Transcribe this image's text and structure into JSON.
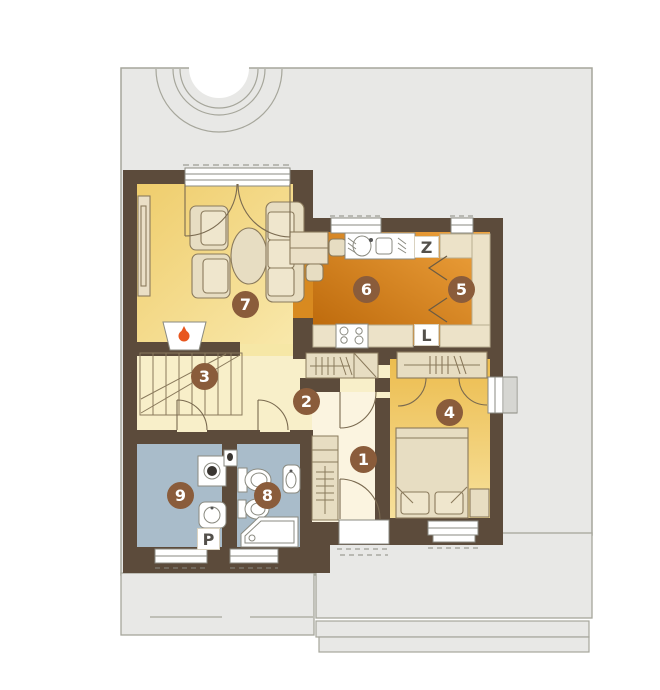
{
  "markers": {
    "m1": "1",
    "m2": "2",
    "m3": "3",
    "m4": "4",
    "m5": "5",
    "m6": "6",
    "m7": "7",
    "m8": "8",
    "m9": "9"
  },
  "appliance_labels": {
    "z": "Z",
    "l": "L",
    "p": "P"
  },
  "colors": {
    "wall": "#5c4b3b",
    "plot_gray": "#e8e8e6",
    "plot_border": "#a6a69b",
    "living_floor": "#f0d172",
    "kitchen_floor": "#d07d1c",
    "bedroom_floor": "#eec156",
    "hallway_floor": "#f8efc9",
    "room1_floor": "#fbf4e0",
    "bathroom_floor": "#a9bcca",
    "furniture": "#e7ddc2",
    "counter": "#ece2c8",
    "marker_bg": "#8a5c3b",
    "flame": "#e8561e"
  }
}
